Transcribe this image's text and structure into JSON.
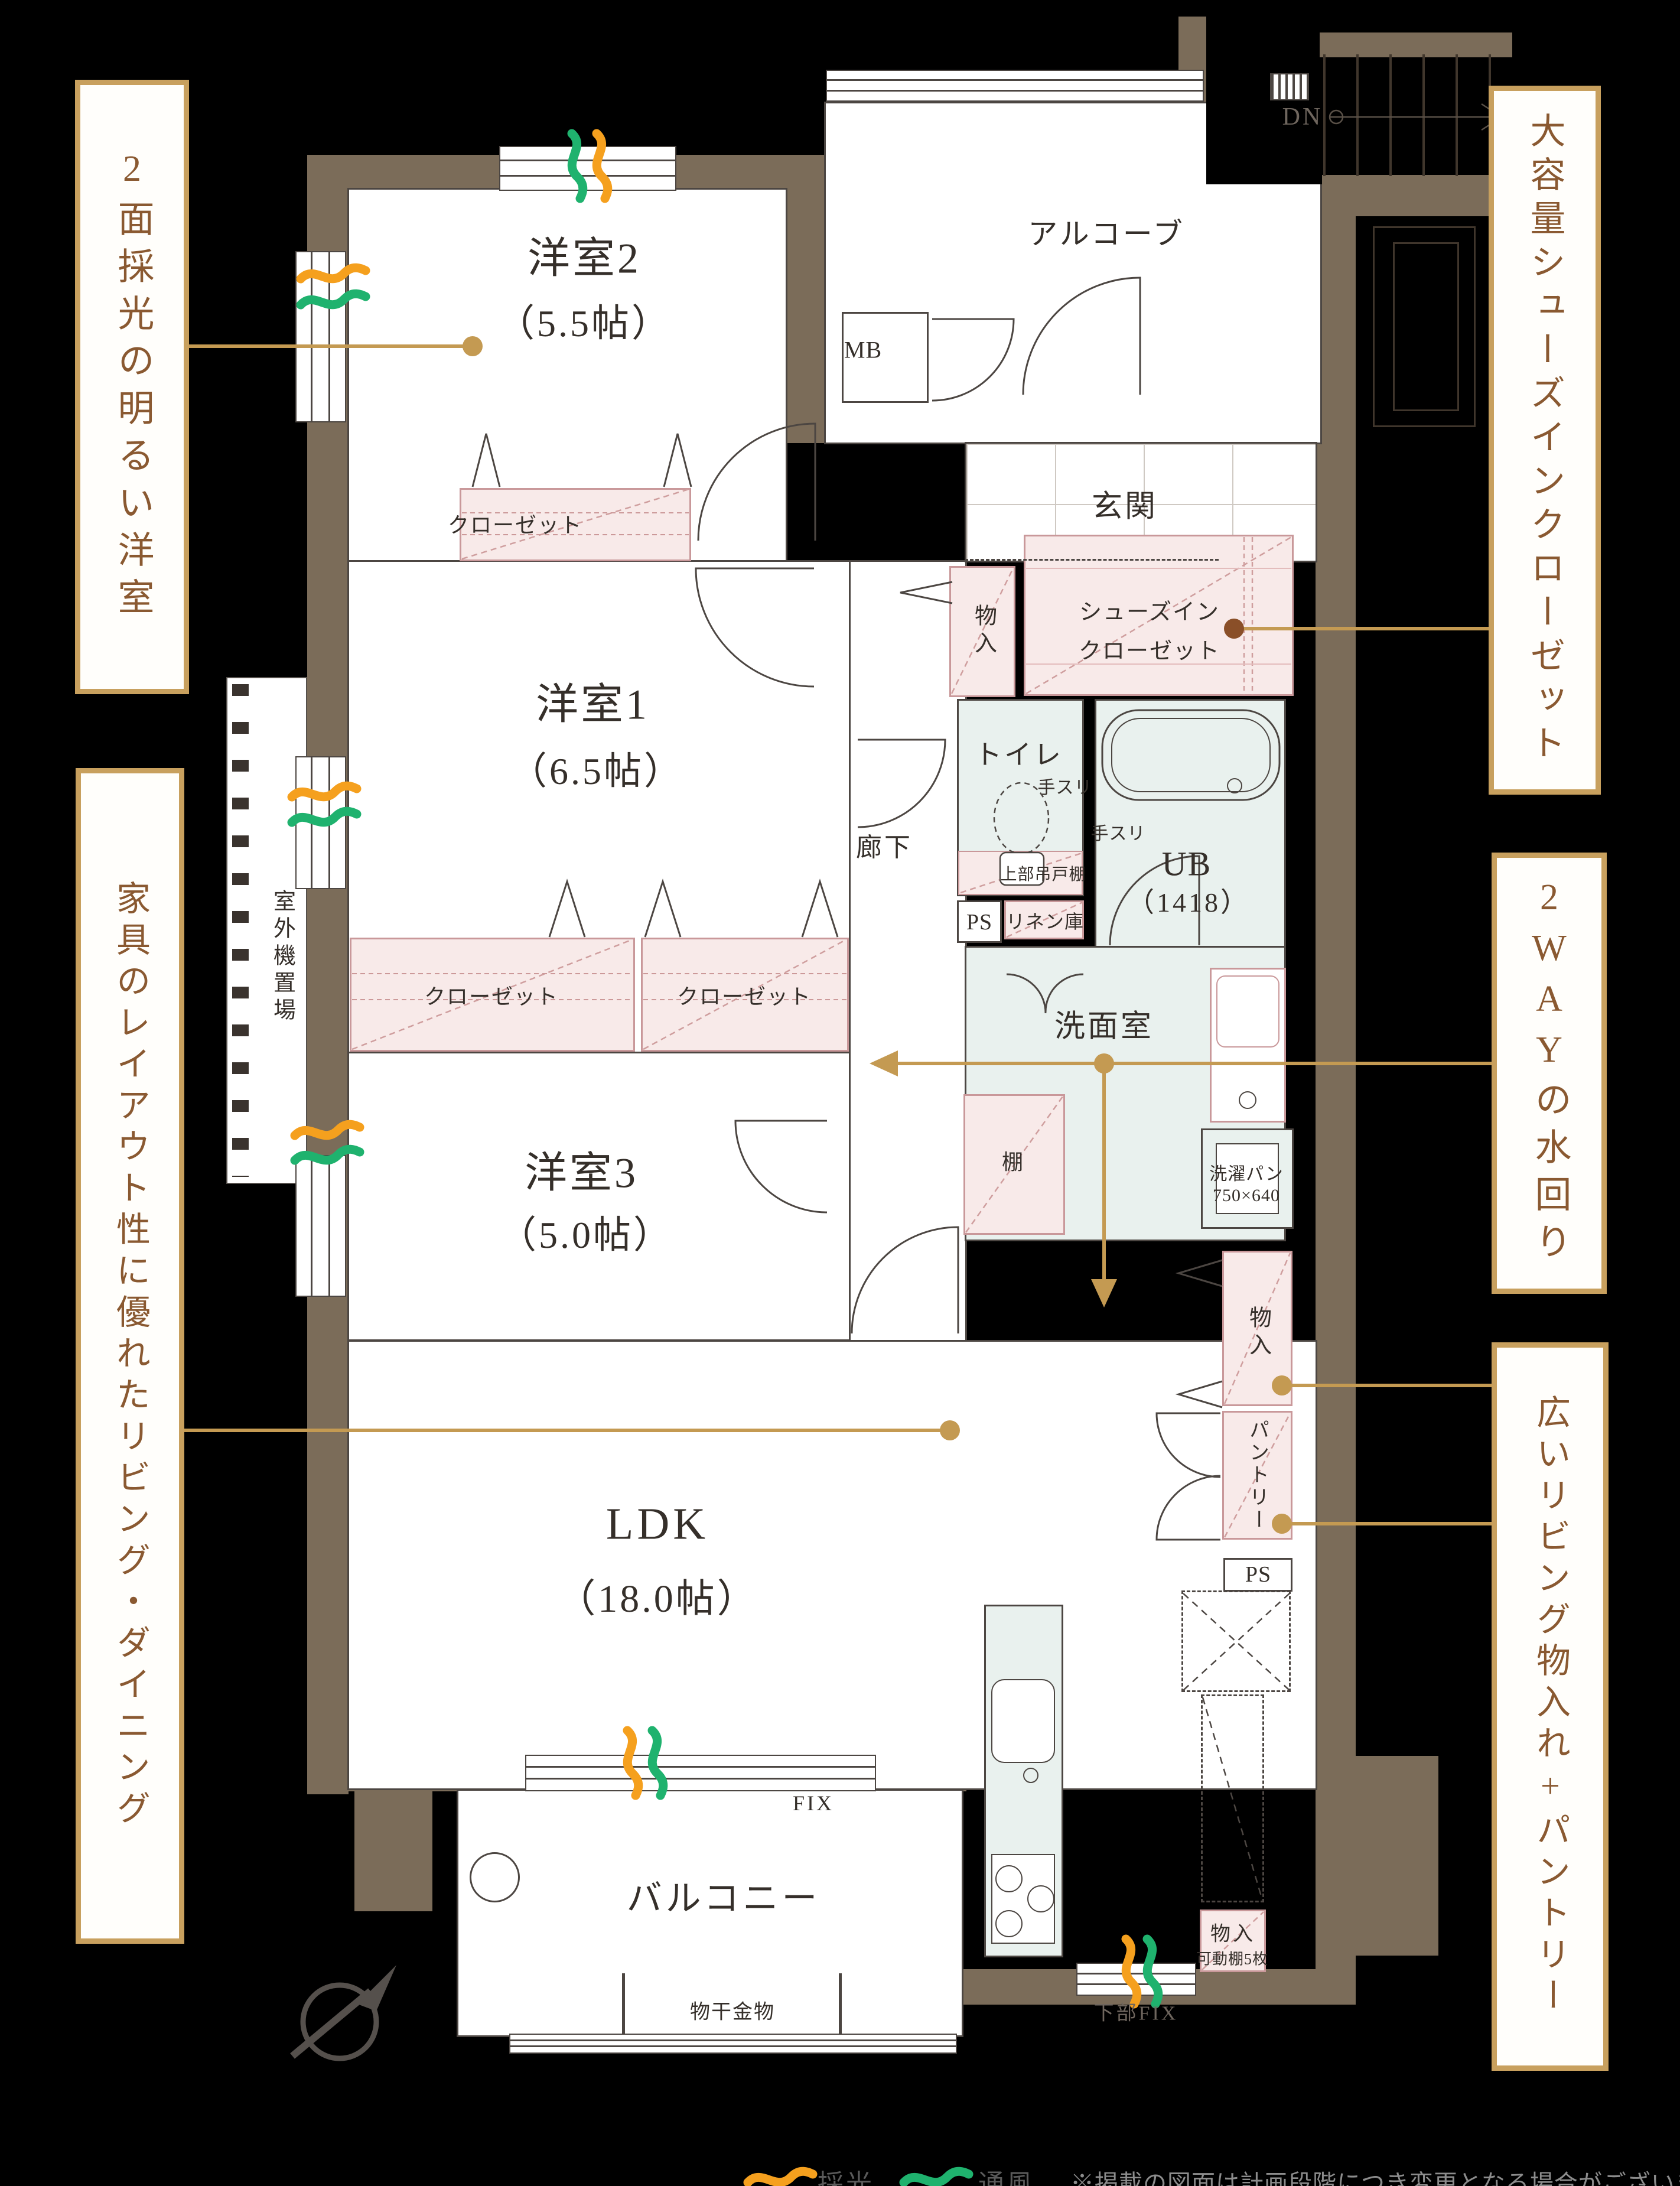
{
  "callouts": [
    {
      "text": "2面採光の明るい洋室"
    },
    {
      "text": "家具のレイアウト性に優れたリビング・ダイニング"
    },
    {
      "text": "大容量シューズインクローゼット"
    },
    {
      "text": "2WAYの水回り"
    },
    {
      "text": "広いリビング物入れ+パントリー"
    }
  ],
  "rooms": {
    "y2": {
      "name": "洋室2",
      "size": "（5.5帖）"
    },
    "y1": {
      "name": "洋室1",
      "size": "（6.5帖）"
    },
    "y3": {
      "name": "洋室3",
      "size": "（5.0帖）"
    },
    "ldk": {
      "name": "LDK",
      "size": "（18.0帖）"
    },
    "ub": {
      "name": "UB",
      "size": "（1418）"
    },
    "balcony": "バルコニー",
    "alcove": "アルコーブ",
    "genkan": "玄関",
    "hall": "廊下",
    "toilet": "トイレ",
    "wash": "洗面室"
  },
  "storage": {
    "closet": "クローゼット",
    "monoire": "物入",
    "sic1": "シューズイン",
    "sic2": "クローゼット",
    "linen": "リネン庫",
    "pantry": "パントリー",
    "shelf": "棚",
    "upper": "上部吊戸棚",
    "movable": "可動棚5枚"
  },
  "fixtures": {
    "mb": "MB",
    "ps": "PS",
    "dn": "DN",
    "fix": "FIX",
    "lowfix": "下部FIX",
    "tesuri": "手スリ",
    "pan": "洗濯パン",
    "pan_size": "750×640",
    "hoshi": "物干金物",
    "outdoor": "室外機置場",
    "north": "N"
  },
  "legend": {
    "light": "採光",
    "vent": "通風",
    "note": "※掲載の図面は計画段階につき変更となる場合がございます"
  }
}
